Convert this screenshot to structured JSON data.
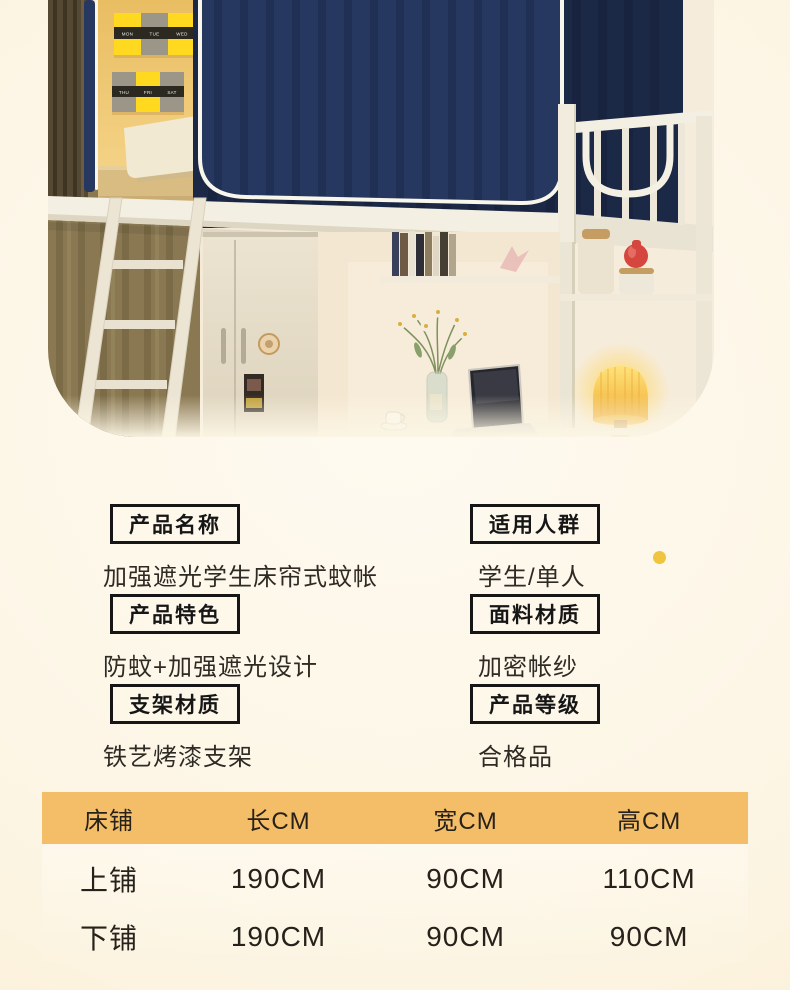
{
  "photo": {
    "calendar_card_1": [
      "MON",
      "TUE",
      "WED"
    ],
    "calendar_card_2": [
      "THU",
      "FRI",
      "SAT"
    ]
  },
  "specs": {
    "items": [
      {
        "label": "产品名称",
        "value": "加强遮光学生床帘式蚊帐"
      },
      {
        "label": "适用人群",
        "value": "学生/单人"
      },
      {
        "label": "产品特色",
        "value": "防蚊+加强遮光设计"
      },
      {
        "label": "面料材质",
        "value": "加密帐纱"
      },
      {
        "label": "支架材质",
        "value": "铁艺烤漆支架"
      },
      {
        "label": "产品等级",
        "value": "合格品"
      }
    ]
  },
  "accent": {
    "dot_color": "#f0c43e",
    "table_header_bg": "#f4bd67",
    "label_border": "#161616",
    "curtain_navy": "#263760",
    "frame_white": "#f3efe3",
    "wall_yellow": "#eec46e"
  },
  "size_table": {
    "headers": [
      "床铺",
      "长CM",
      "宽CM",
      "高CM"
    ],
    "rows": [
      [
        "上铺",
        "190CM",
        "90CM",
        "110CM"
      ],
      [
        "下铺",
        "190CM",
        "90CM",
        "90CM"
      ]
    ]
  }
}
